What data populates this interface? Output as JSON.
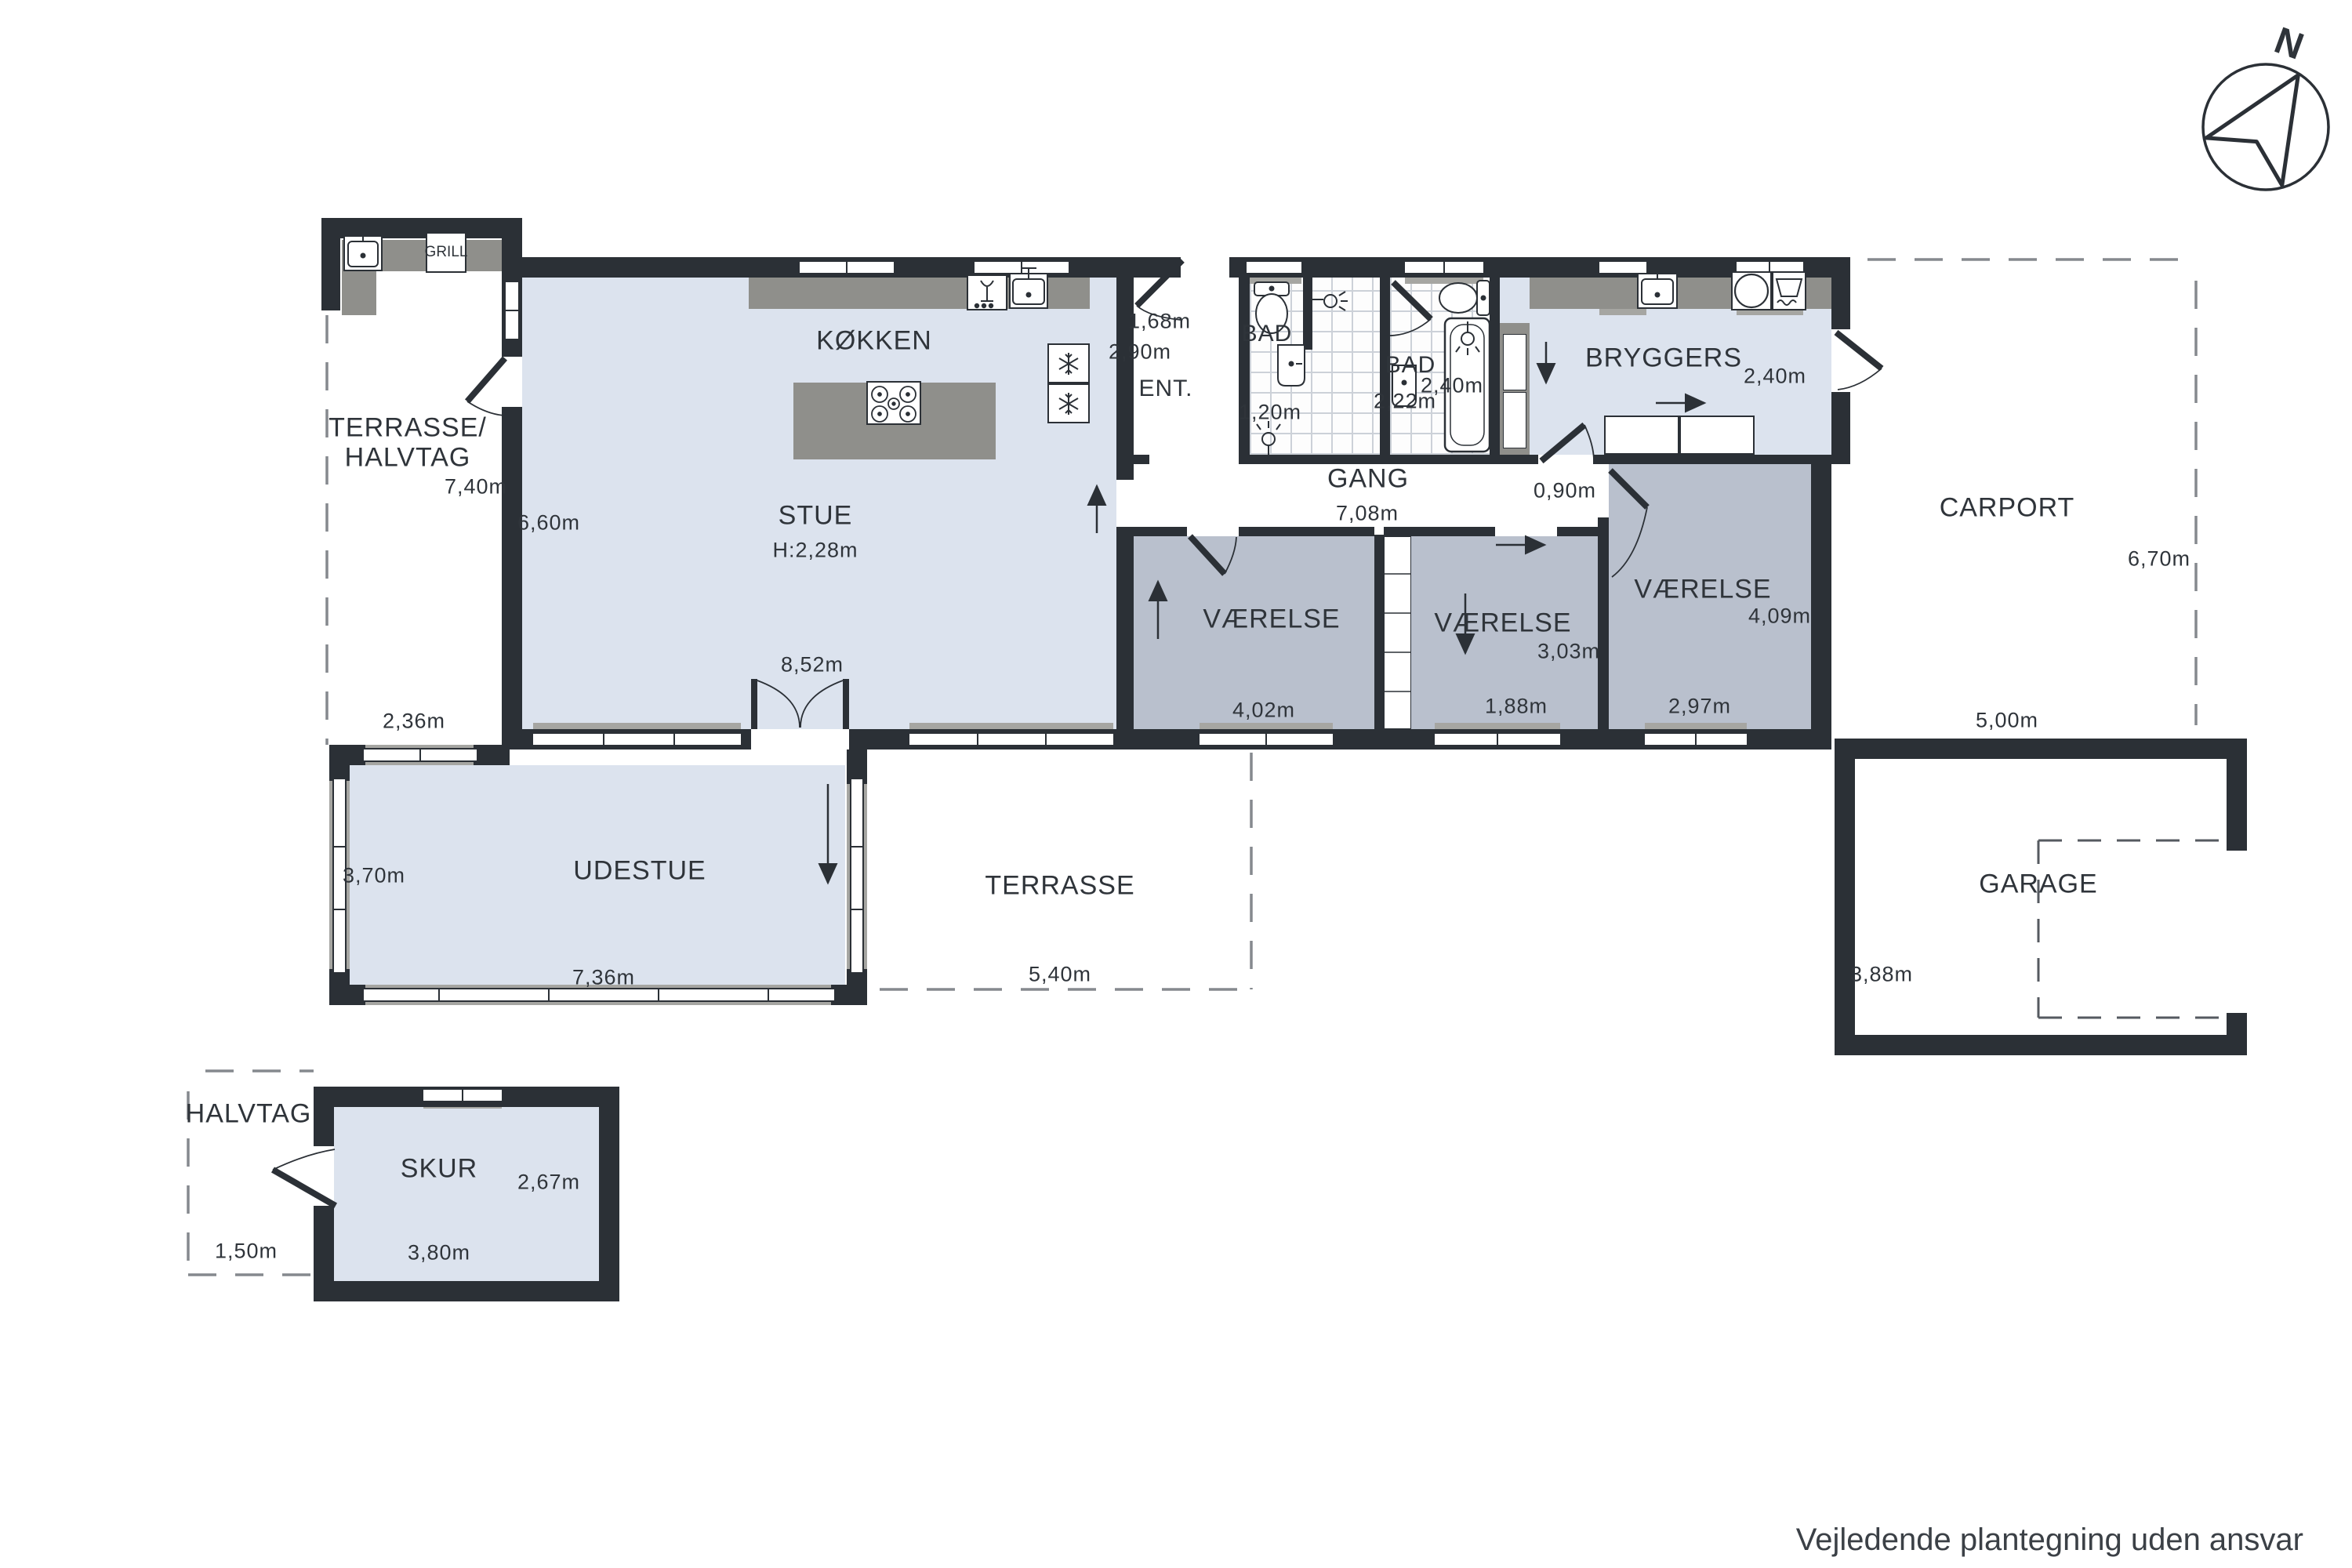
{
  "plan": {
    "footer": "Vejledende plantegning uden ansvar",
    "compass": "N",
    "outdoor_kitchen": {
      "grill": "GRILL"
    },
    "terrasse_halvtag": {
      "line1": "TERRASSE/",
      "line2": "HALVTAG",
      "depth": "7,40m",
      "gap": "2,36m"
    },
    "koekken": {
      "name": "KØKKEN"
    },
    "stue": {
      "name": "STUE",
      "ceiling": "H:2,28m",
      "width": "8,52m",
      "height": "6,60m"
    },
    "ent": {
      "name": "ENT.",
      "width": "1,68m",
      "height": "2,90m"
    },
    "bad1": {
      "name": "BAD",
      "dim": "1,20m"
    },
    "bad2": {
      "name": "BAD",
      "width": "2,22m",
      "height": "2,40m"
    },
    "bryggers": {
      "name": "BRYGGERS",
      "height": "2,40m"
    },
    "gang": {
      "name": "GANG",
      "length": "7,08m",
      "passage": "0,90m"
    },
    "vaerelse1": {
      "name": "VÆRELSE",
      "width": "4,02m"
    },
    "vaerelse2": {
      "name": "VÆRELSE",
      "height": "3,03m",
      "width": "1,88m"
    },
    "vaerelse3": {
      "name": "VÆRELSE",
      "height": "4,09m",
      "width": "2,97m"
    },
    "carport": {
      "name": "CARPORT",
      "height": "6,70m"
    },
    "garage": {
      "name": "GARAGE",
      "width": "5,00m",
      "height": "3,88m"
    },
    "udestue": {
      "name": "UDESTUE",
      "height": "3,70m",
      "width": "7,36m"
    },
    "terrasse": {
      "name": "TERRASSE",
      "width": "5,40m"
    },
    "skur": {
      "name": "SKUR",
      "width": "3,80m",
      "height": "2,67m"
    },
    "halvtag": {
      "name": "HALVTAG",
      "width": "1,50m"
    },
    "colors": {
      "wall": "#2b3036",
      "floor_light": "#dce3ee",
      "floor_room": "#b9c0cd",
      "counter": "#8f8f8b",
      "frame": "#a6a6a2"
    }
  }
}
